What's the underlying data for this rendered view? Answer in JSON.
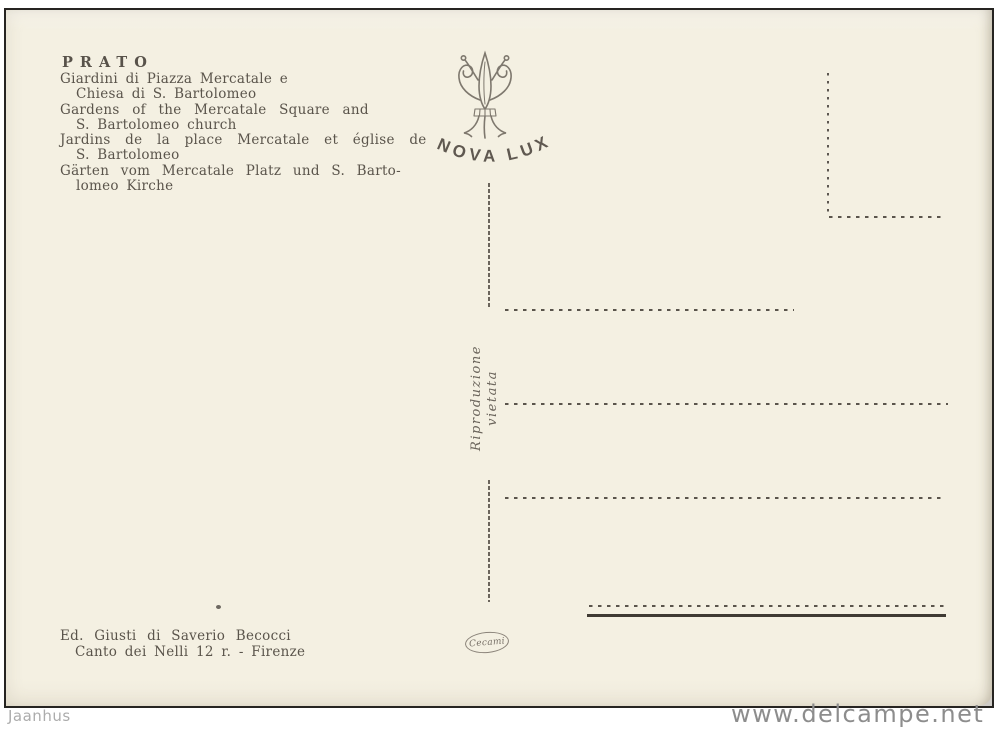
{
  "postcard": {
    "title": "PRATO",
    "caption_lines": [
      {
        "text": "Giardini di Piazza Mercatale e"
      },
      {
        "text": "Chiesa di S. Bartolomeo"
      },
      {
        "text": "Gardens of the Mercatale Square and"
      },
      {
        "text": "S. Bartolomeo church"
      },
      {
        "text": "Jardins de la place Mercatale et église de"
      },
      {
        "text": "S. Bartolomeo"
      },
      {
        "text": "Gärten vom Mercatale Platz und S. Barto-"
      },
      {
        "text": "lomeo Kirche"
      }
    ],
    "brand_mark": {
      "icon": "fleur-de-lis-icon",
      "label": "NOVA LUX"
    },
    "reproduction_notice": "Riproduzione vietata",
    "publisher": {
      "line1": "Ed. Giusti di Saverio Becocci",
      "line2": "Canto dei Nelli 12 r. - Firenze"
    },
    "printer_logo_text": "Cecami"
  },
  "watermarks": {
    "left": "Jaanhus",
    "right": "www.delcampe.net"
  },
  "colors": {
    "card_paper": "#f4f0e2",
    "ink": "#58524a",
    "frame_border": "#262421",
    "watermark_left_gray": "#acacac",
    "watermark_right_gray": "#8d8d8d"
  }
}
